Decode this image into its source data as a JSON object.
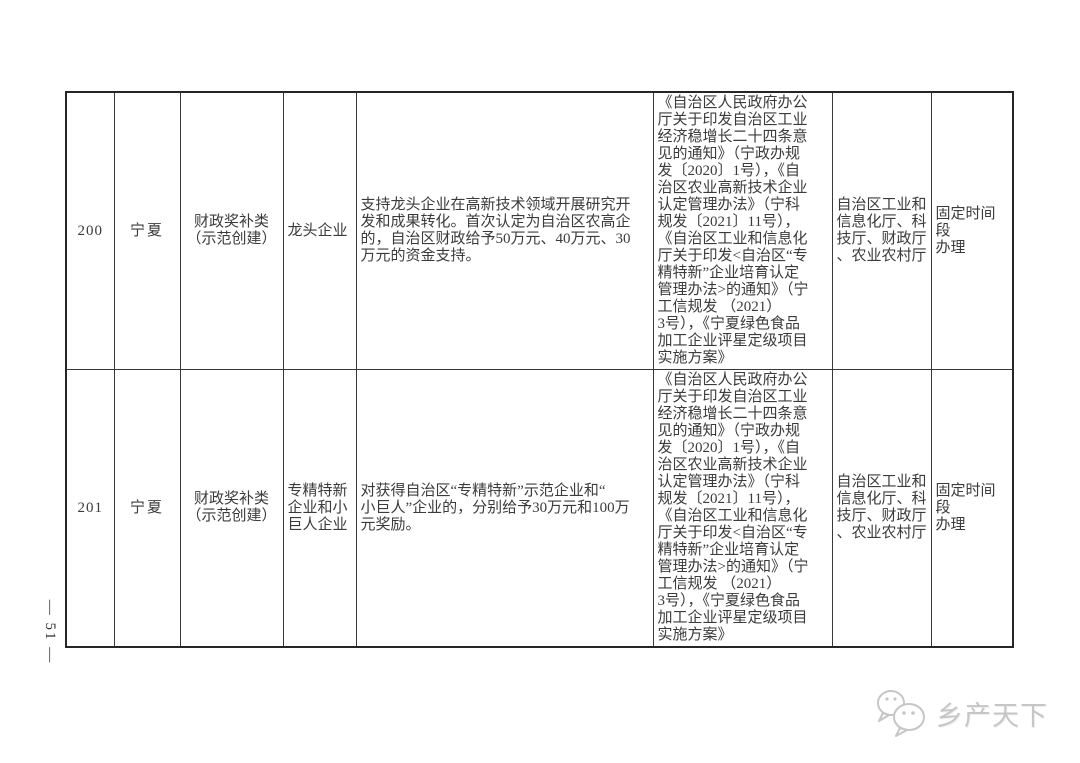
{
  "page": {
    "side_page_number": "— 51 —"
  },
  "watermark": {
    "brand_text": "乡产天下",
    "icon": "chat-bubbles-icon",
    "color": "#c6c6c6"
  },
  "table": {
    "border_color": "#3a3a3a",
    "rows": [
      {
        "no": "200",
        "region": "宁夏",
        "category": "财政奖补类\n（示范创建）",
        "enterprise_type": "龙头企业",
        "support_content": "支持龙头企业在高新技术领域开展研究开\n发和成果转化。首次认定为自治区农高企\n的，自治区财政给予50万元、40万元、30\n万元的资金支持。",
        "policy_basis": "《自治区人民政府办公\n厅关于印发自治区工业\n经济稳增长二十四条意\n见的通知》（宁政办规\n发〔2020〕1号），《自\n治区农业高新技术企业\n认定管理办法》（宁科\n规发〔2021〕11号），\n《自治区工业和信息化\n厅关于印发<自治区“专\n精特新”企业培育认定\n管理办法>的通知》（宁\n工信规发 （2021）\n3号），《宁夏绿色食品\n加工企业评星定级项目\n实施方案》",
        "departments": "自治区工业和\n信息化厅、科\n技厅、财政厅\n、农业农村厅",
        "handling": "固定时间段\n办理"
      },
      {
        "no": "201",
        "region": "宁夏",
        "category": "财政奖补类\n（示范创建）",
        "enterprise_type": "专精特新\n企业和小\n巨人企业",
        "support_content": "对获得自治区“专精特新”示范企业和“\n小巨人”企业的，分别给予30万元和100万\n元奖励。",
        "policy_basis": "《自治区人民政府办公\n厅关于印发自治区工业\n经济稳增长二十四条意\n见的通知》（宁政办规\n发〔2020〕1号），《自\n治区农业高新技术企业\n认定管理办法》（宁科\n规发〔2021〕11号），\n《自治区工业和信息化\n厅关于印发<自治区“专\n精特新”企业培育认定\n管理办法>的通知》（宁\n工信规发 （2021）\n3号），《宁夏绿色食品\n加工企业评星定级项目\n实施方案》",
        "departments": "自治区工业和\n信息化厅、科\n技厅、财政厅\n、农业农村厅",
        "handling": "固定时间段\n办理"
      }
    ]
  }
}
